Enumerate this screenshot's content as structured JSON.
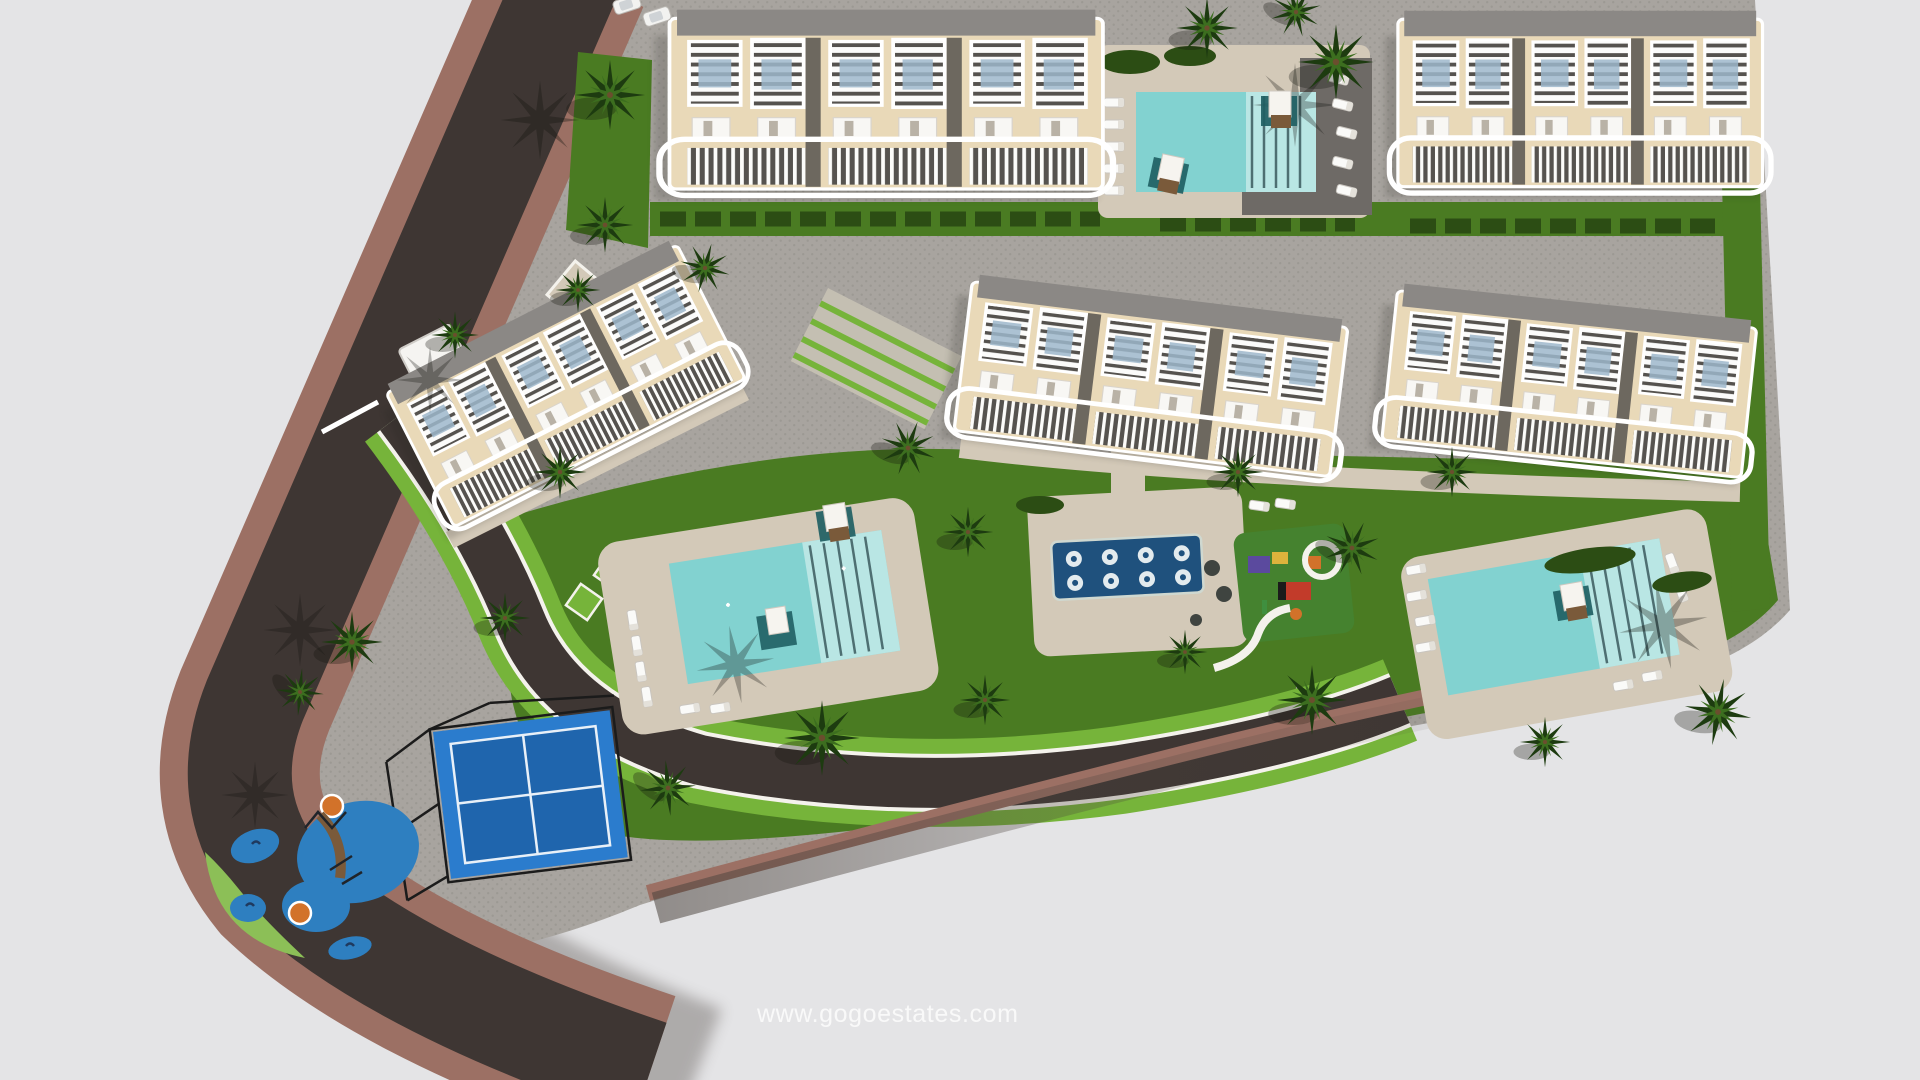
{
  "watermark": {
    "text": "www.gogoestates.com"
  },
  "scene": {
    "type": "3d-aerial-site-plan",
    "description": "Bird's-eye architectural render of a coastal residential complex on a triangular parcel bounded by a curving road",
    "buildings": {
      "count": 5,
      "labels": [
        "north-west-block",
        "north-east-block",
        "mid-west-block",
        "mid-center-block",
        "mid-east-block"
      ],
      "units_per_block": 3
    },
    "amenities": [
      "north-pool",
      "west-pool",
      "east-pool",
      "spa-pool-with-in-water-loungers",
      "kids-playground-east",
      "splash-playground-south-west",
      "padel-court",
      "palm-gardens",
      "sun-lounger-decks"
    ],
    "spa_pool": {
      "lounger_circles": 8,
      "rows": 2
    },
    "vehicles": {
      "parked_cars": 2
    }
  },
  "palette": {
    "bg": "#e4e4e6",
    "paving": "#a8a49f",
    "pavingDot": "#8f8b86",
    "asphalt": "#3e3633",
    "roadShadow": "#4a423c",
    "sidewalk": "#9c7064",
    "deck": "#d3c9b8",
    "deckDark": "#6e6a66",
    "lawn": "#4a7b22",
    "lawnBright": "#76b43a",
    "lawnLight": "#8cbf57",
    "hedge": "#2c4d14",
    "palmDark": "#1d3b10",
    "palmLight": "#3c6e1f",
    "pool": "#82d2d0",
    "poolLight": "#bfe8e6",
    "spa": "#1f517d",
    "spaDot": "#e3ebee",
    "court": "#2b7ccd",
    "courtDark": "#1f65ad",
    "playBlue": "#2e7fc0",
    "facade": "#e9d9b8",
    "roofGray": "#8b8885",
    "slat": "#56534f",
    "panel": "#9db7cb",
    "cream": "#f4f2ec",
    "brown": "#7a5a3a",
    "teal": "#1f5f63",
    "orange": "#d2722a",
    "red": "#c23b2a",
    "yellow": "#ddb33c",
    "purple": "#5b4a9e"
  }
}
